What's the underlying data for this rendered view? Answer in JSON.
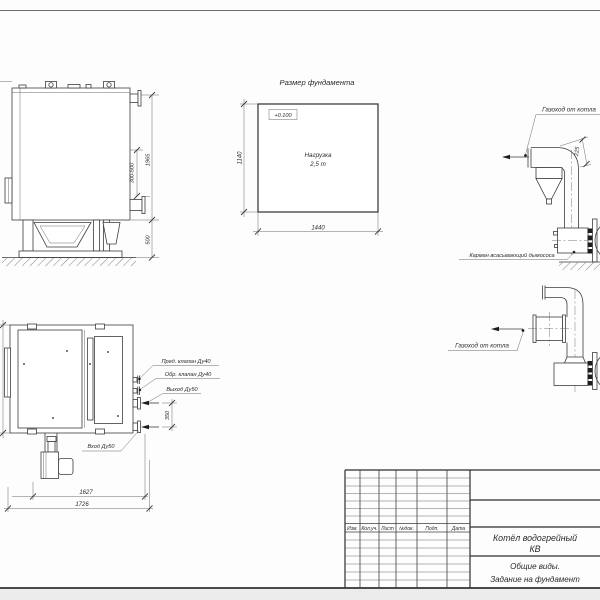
{
  "side_view": {
    "dim_range": "300-500",
    "dim_total": "1965",
    "dim_base": "500"
  },
  "foundation": {
    "title": "Размер фундамента",
    "level_mark": "+0.100",
    "load_line1": "Нагрузка",
    "load_line2": "2,5 т",
    "dim_width": "1440",
    "dim_depth": "1140"
  },
  "flue_top": {
    "flue_label": "Газоход от котла",
    "dim_offset": "225",
    "pocket_label": "Карман всасывающий дымососа"
  },
  "flue_front": {
    "flue_label": "Газоход от котла"
  },
  "plan": {
    "safety_valve": "Пред. клапан Ду40",
    "check_valve": "Обр. клапан Ду40",
    "outlet": "Выход Ду50",
    "inlet": "Вход Ду50",
    "dim_ports": "350",
    "dim_inner": "1627",
    "dim_outer": "1726"
  },
  "title_block": {
    "columns": [
      "Изм.",
      "Кол.уч.",
      "Лист",
      "№док.",
      "Подп.",
      "Дата"
    ],
    "product_line1": "Котёл водогрейный",
    "product_line2": "КВ",
    "doc_line1": "Общие виды.",
    "doc_line2": "Задание на фундамент"
  }
}
